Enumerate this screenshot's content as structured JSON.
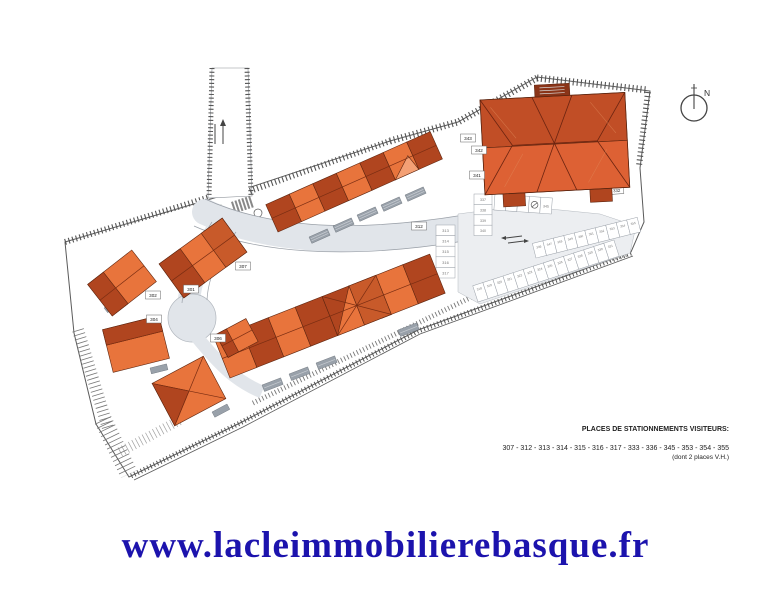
{
  "footer": {
    "url": "www.lacleimmobilierebasque.fr"
  },
  "legend": {
    "title": "PLACES DE STATIONNEMENTS VISITEURS:",
    "numbers": "307 - 312 - 313 - 314 - 315 - 316 - 317 - 333 - 336 - 345 - 353 - 354 - 355",
    "note": "(dont 2 places V.H.)"
  },
  "compass": {
    "label": "N"
  },
  "plan": {
    "colors": {
      "roof_dark": "#b0451f",
      "roof_light": "#e8743c",
      "roof_stripe": "#f4a074",
      "building_upper": "#c14e26",
      "building_lower": "#dd6134",
      "road": "#e1e5ea",
      "lot": "#eceef1",
      "green": "#4c7c44",
      "terrace": "#99a1aa",
      "line": "#555555",
      "url_blue": "#1c13ad"
    },
    "lot_labels": [
      "301",
      "302",
      "304",
      "306",
      "307",
      "312",
      "341",
      "342",
      "343",
      "344 332"
    ],
    "stall_col": [
      "313",
      "314",
      "315",
      "316",
      "317"
    ],
    "stall_col2": [
      "337",
      "338",
      "339",
      "340"
    ],
    "stall_rowd": [
      "",
      "335",
      "336",
      "",
      "345"
    ],
    "stall_row1": [
      "318",
      "319",
      "320",
      "321",
      "322",
      "323",
      "324",
      "325",
      "326",
      "327",
      "328",
      "329",
      "330",
      "331"
    ],
    "stall_row2": [
      "346",
      "347",
      "348",
      "349",
      "350",
      "351",
      "352",
      "353",
      "354",
      "355"
    ]
  }
}
